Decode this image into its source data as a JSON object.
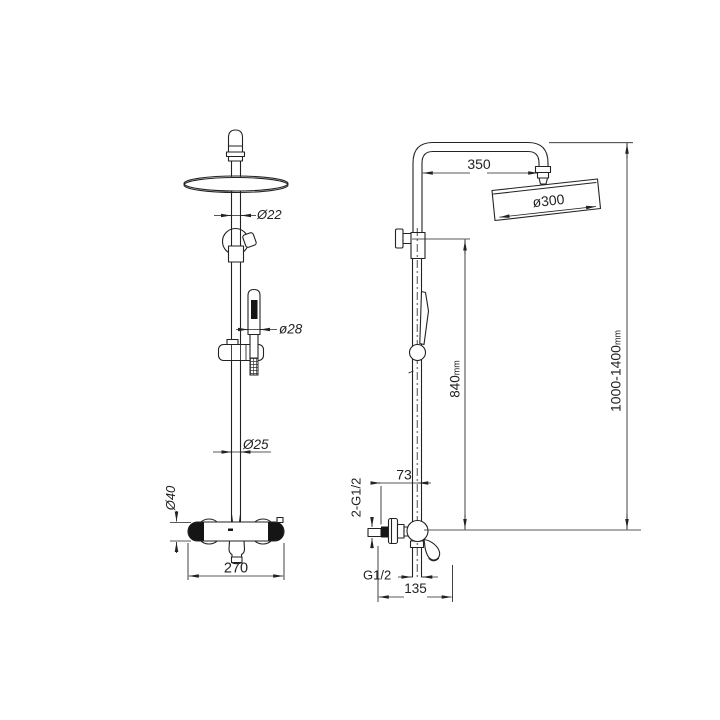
{
  "page": {
    "background": "#ffffff",
    "line_color": "#222222",
    "description": "Technical dimension drawing of a thermostatic shower column, front view and side view"
  },
  "views": {
    "front": {
      "name": "front view",
      "dims": {
        "pipe_top_diameter": "Ø22",
        "handshower_diameter": "ø28",
        "riser_diameter": "Ø25",
        "valve_body_diameter": "Ø40",
        "valve_width": "270"
      }
    },
    "side": {
      "name": "side view",
      "dims": {
        "arm_reach": "350",
        "head_diameter": "ø300",
        "riser_height": {
          "value": "840",
          "unit": "mm"
        },
        "overall_height": {
          "value": "1000-1400",
          "unit": "mm"
        },
        "wall_to_center": "73",
        "inlet_connections": "2-G1/2",
        "outlet_connection": "G1/2",
        "base_depth": "135"
      }
    }
  }
}
